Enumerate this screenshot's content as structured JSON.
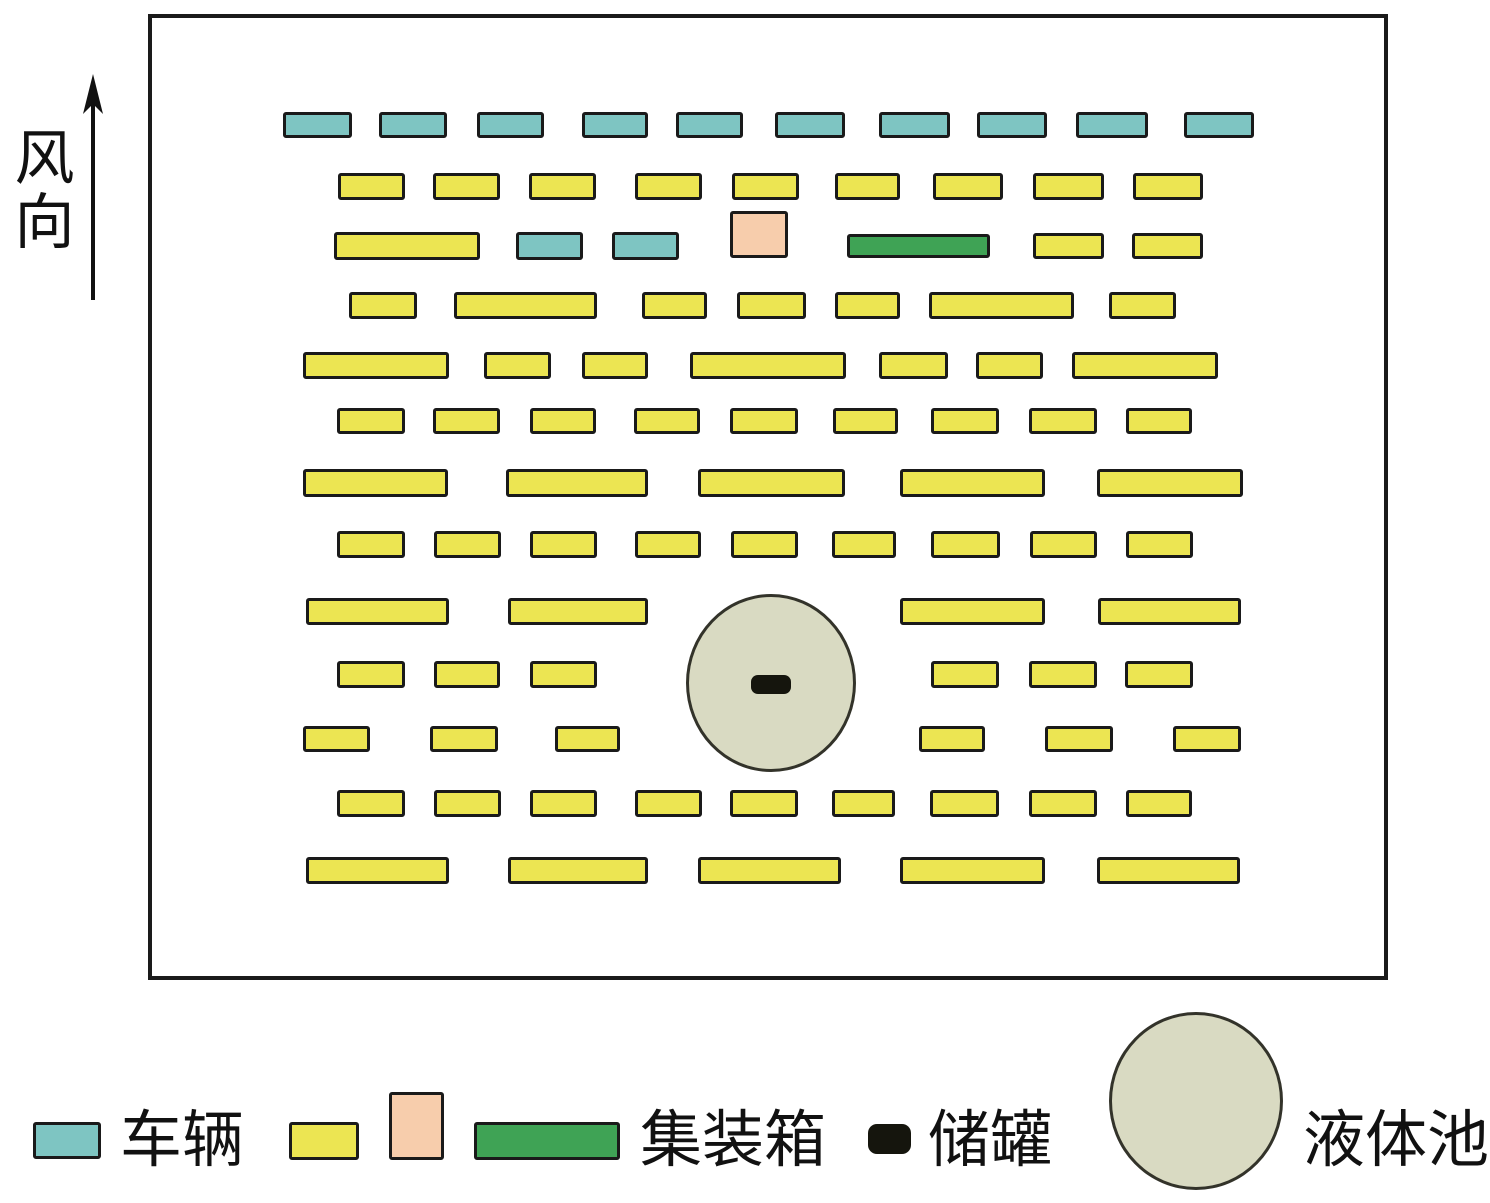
{
  "wind": {
    "label": "风向"
  },
  "colors": {
    "vehicle": "#7EC5C2",
    "container_yellow": "#ECE552",
    "container_pink": "#F7CDAC",
    "container_green": "#3FA355",
    "tank": "#15150D",
    "pool_fill": "#D9DAC2",
    "outline": "#1A1A1A"
  },
  "legend": {
    "items": [
      {
        "symbol": "vehicle-swatch",
        "label": "车辆"
      },
      {
        "symbol": "container-swatches",
        "label": "集装箱"
      },
      {
        "symbol": "tank-swatch",
        "label": "储罐"
      },
      {
        "symbol": "pool-swatch",
        "label": "液体池"
      }
    ]
  },
  "diagram": {
    "border": {
      "x": 148,
      "y": 14,
      "w": 1240,
      "h": 966
    },
    "pool": {
      "x": 686,
      "y": 594,
      "w": 170,
      "h": 178
    },
    "tank": {
      "x": 751,
      "y": 675,
      "w": 40,
      "h": 19
    },
    "shapes": [
      {
        "type": "vehicle",
        "x": 283,
        "y": 112,
        "w": 69,
        "h": 26
      },
      {
        "type": "vehicle",
        "x": 379,
        "y": 112,
        "w": 68,
        "h": 26
      },
      {
        "type": "vehicle",
        "x": 477,
        "y": 112,
        "w": 67,
        "h": 26
      },
      {
        "type": "vehicle",
        "x": 582,
        "y": 112,
        "w": 66,
        "h": 26
      },
      {
        "type": "vehicle",
        "x": 676,
        "y": 112,
        "w": 67,
        "h": 26
      },
      {
        "type": "vehicle",
        "x": 775,
        "y": 112,
        "w": 70,
        "h": 26
      },
      {
        "type": "vehicle",
        "x": 879,
        "y": 112,
        "w": 71,
        "h": 26
      },
      {
        "type": "vehicle",
        "x": 977,
        "y": 112,
        "w": 70,
        "h": 26
      },
      {
        "type": "vehicle",
        "x": 1076,
        "y": 112,
        "w": 72,
        "h": 26
      },
      {
        "type": "vehicle",
        "x": 1184,
        "y": 112,
        "w": 70,
        "h": 26
      },
      {
        "type": "yellow",
        "x": 338,
        "y": 173,
        "w": 67,
        "h": 27
      },
      {
        "type": "yellow",
        "x": 433,
        "y": 173,
        "w": 67,
        "h": 27
      },
      {
        "type": "yellow",
        "x": 529,
        "y": 173,
        "w": 67,
        "h": 27
      },
      {
        "type": "yellow",
        "x": 635,
        "y": 173,
        "w": 67,
        "h": 27
      },
      {
        "type": "yellow",
        "x": 732,
        "y": 173,
        "w": 67,
        "h": 27
      },
      {
        "type": "yellow",
        "x": 835,
        "y": 173,
        "w": 65,
        "h": 27
      },
      {
        "type": "yellow",
        "x": 933,
        "y": 173,
        "w": 70,
        "h": 27
      },
      {
        "type": "yellow",
        "x": 1033,
        "y": 173,
        "w": 71,
        "h": 27
      },
      {
        "type": "yellow",
        "x": 1133,
        "y": 173,
        "w": 70,
        "h": 27
      },
      {
        "type": "yellow",
        "x": 334,
        "y": 232,
        "w": 146,
        "h": 28
      },
      {
        "type": "vehicle",
        "x": 516,
        "y": 232,
        "w": 67,
        "h": 28
      },
      {
        "type": "vehicle",
        "x": 612,
        "y": 232,
        "w": 67,
        "h": 28
      },
      {
        "type": "pink",
        "x": 730,
        "y": 211,
        "w": 58,
        "h": 47
      },
      {
        "type": "green",
        "x": 847,
        "y": 234,
        "w": 143,
        "h": 24
      },
      {
        "type": "yellow",
        "x": 1033,
        "y": 233,
        "w": 71,
        "h": 26
      },
      {
        "type": "yellow",
        "x": 1132,
        "y": 233,
        "w": 71,
        "h": 26
      },
      {
        "type": "yellow",
        "x": 349,
        "y": 292,
        "w": 68,
        "h": 27
      },
      {
        "type": "yellow",
        "x": 454,
        "y": 292,
        "w": 143,
        "h": 27
      },
      {
        "type": "yellow",
        "x": 642,
        "y": 292,
        "w": 65,
        "h": 27
      },
      {
        "type": "yellow",
        "x": 737,
        "y": 292,
        "w": 69,
        "h": 27
      },
      {
        "type": "yellow",
        "x": 835,
        "y": 292,
        "w": 65,
        "h": 27
      },
      {
        "type": "yellow",
        "x": 929,
        "y": 292,
        "w": 145,
        "h": 27
      },
      {
        "type": "yellow",
        "x": 1109,
        "y": 292,
        "w": 67,
        "h": 27
      },
      {
        "type": "yellow",
        "x": 303,
        "y": 352,
        "w": 146,
        "h": 27
      },
      {
        "type": "yellow",
        "x": 484,
        "y": 352,
        "w": 67,
        "h": 27
      },
      {
        "type": "yellow",
        "x": 582,
        "y": 352,
        "w": 66,
        "h": 27
      },
      {
        "type": "yellow",
        "x": 690,
        "y": 352,
        "w": 156,
        "h": 27
      },
      {
        "type": "yellow",
        "x": 879,
        "y": 352,
        "w": 69,
        "h": 27
      },
      {
        "type": "yellow",
        "x": 976,
        "y": 352,
        "w": 67,
        "h": 27
      },
      {
        "type": "yellow",
        "x": 1072,
        "y": 352,
        "w": 146,
        "h": 27
      },
      {
        "type": "yellow",
        "x": 337,
        "y": 408,
        "w": 68,
        "h": 26
      },
      {
        "type": "yellow",
        "x": 433,
        "y": 408,
        "w": 67,
        "h": 26
      },
      {
        "type": "yellow",
        "x": 530,
        "y": 408,
        "w": 66,
        "h": 26
      },
      {
        "type": "yellow",
        "x": 634,
        "y": 408,
        "w": 66,
        "h": 26
      },
      {
        "type": "yellow",
        "x": 730,
        "y": 408,
        "w": 68,
        "h": 26
      },
      {
        "type": "yellow",
        "x": 833,
        "y": 408,
        "w": 65,
        "h": 26
      },
      {
        "type": "yellow",
        "x": 931,
        "y": 408,
        "w": 68,
        "h": 26
      },
      {
        "type": "yellow",
        "x": 1029,
        "y": 408,
        "w": 68,
        "h": 26
      },
      {
        "type": "yellow",
        "x": 1126,
        "y": 408,
        "w": 66,
        "h": 26
      },
      {
        "type": "yellow",
        "x": 303,
        "y": 469,
        "w": 145,
        "h": 28
      },
      {
        "type": "yellow",
        "x": 506,
        "y": 469,
        "w": 142,
        "h": 28
      },
      {
        "type": "yellow",
        "x": 698,
        "y": 469,
        "w": 147,
        "h": 28
      },
      {
        "type": "yellow",
        "x": 900,
        "y": 469,
        "w": 145,
        "h": 28
      },
      {
        "type": "yellow",
        "x": 1097,
        "y": 469,
        "w": 146,
        "h": 28
      },
      {
        "type": "yellow",
        "x": 337,
        "y": 531,
        "w": 68,
        "h": 27
      },
      {
        "type": "yellow",
        "x": 434,
        "y": 531,
        "w": 67,
        "h": 27
      },
      {
        "type": "yellow",
        "x": 530,
        "y": 531,
        "w": 67,
        "h": 27
      },
      {
        "type": "yellow",
        "x": 635,
        "y": 531,
        "w": 66,
        "h": 27
      },
      {
        "type": "yellow",
        "x": 731,
        "y": 531,
        "w": 67,
        "h": 27
      },
      {
        "type": "yellow",
        "x": 832,
        "y": 531,
        "w": 64,
        "h": 27
      },
      {
        "type": "yellow",
        "x": 931,
        "y": 531,
        "w": 69,
        "h": 27
      },
      {
        "type": "yellow",
        "x": 1030,
        "y": 531,
        "w": 67,
        "h": 27
      },
      {
        "type": "yellow",
        "x": 1126,
        "y": 531,
        "w": 67,
        "h": 27
      },
      {
        "type": "yellow",
        "x": 306,
        "y": 598,
        "w": 143,
        "h": 27
      },
      {
        "type": "yellow",
        "x": 508,
        "y": 598,
        "w": 140,
        "h": 27
      },
      {
        "type": "yellow",
        "x": 900,
        "y": 598,
        "w": 145,
        "h": 27
      },
      {
        "type": "yellow",
        "x": 1098,
        "y": 598,
        "w": 143,
        "h": 27
      },
      {
        "type": "yellow",
        "x": 337,
        "y": 661,
        "w": 68,
        "h": 27
      },
      {
        "type": "yellow",
        "x": 434,
        "y": 661,
        "w": 66,
        "h": 27
      },
      {
        "type": "yellow",
        "x": 530,
        "y": 661,
        "w": 67,
        "h": 27
      },
      {
        "type": "yellow",
        "x": 931,
        "y": 661,
        "w": 68,
        "h": 27
      },
      {
        "type": "yellow",
        "x": 1029,
        "y": 661,
        "w": 68,
        "h": 27
      },
      {
        "type": "yellow",
        "x": 1125,
        "y": 661,
        "w": 68,
        "h": 27
      },
      {
        "type": "yellow",
        "x": 303,
        "y": 726,
        "w": 67,
        "h": 26
      },
      {
        "type": "yellow",
        "x": 430,
        "y": 726,
        "w": 68,
        "h": 26
      },
      {
        "type": "yellow",
        "x": 555,
        "y": 726,
        "w": 65,
        "h": 26
      },
      {
        "type": "yellow",
        "x": 919,
        "y": 726,
        "w": 66,
        "h": 26
      },
      {
        "type": "yellow",
        "x": 1045,
        "y": 726,
        "w": 68,
        "h": 26
      },
      {
        "type": "yellow",
        "x": 1173,
        "y": 726,
        "w": 68,
        "h": 26
      },
      {
        "type": "yellow",
        "x": 337,
        "y": 790,
        "w": 68,
        "h": 27
      },
      {
        "type": "yellow",
        "x": 434,
        "y": 790,
        "w": 67,
        "h": 27
      },
      {
        "type": "yellow",
        "x": 530,
        "y": 790,
        "w": 67,
        "h": 27
      },
      {
        "type": "yellow",
        "x": 635,
        "y": 790,
        "w": 67,
        "h": 27
      },
      {
        "type": "yellow",
        "x": 730,
        "y": 790,
        "w": 68,
        "h": 27
      },
      {
        "type": "yellow",
        "x": 832,
        "y": 790,
        "w": 63,
        "h": 27
      },
      {
        "type": "yellow",
        "x": 930,
        "y": 790,
        "w": 69,
        "h": 27
      },
      {
        "type": "yellow",
        "x": 1029,
        "y": 790,
        "w": 68,
        "h": 27
      },
      {
        "type": "yellow",
        "x": 1126,
        "y": 790,
        "w": 66,
        "h": 27
      },
      {
        "type": "yellow",
        "x": 306,
        "y": 857,
        "w": 143,
        "h": 27
      },
      {
        "type": "yellow",
        "x": 508,
        "y": 857,
        "w": 140,
        "h": 27
      },
      {
        "type": "yellow",
        "x": 698,
        "y": 857,
        "w": 143,
        "h": 27
      },
      {
        "type": "yellow",
        "x": 900,
        "y": 857,
        "w": 145,
        "h": 27
      },
      {
        "type": "yellow",
        "x": 1097,
        "y": 857,
        "w": 143,
        "h": 27
      }
    ]
  }
}
